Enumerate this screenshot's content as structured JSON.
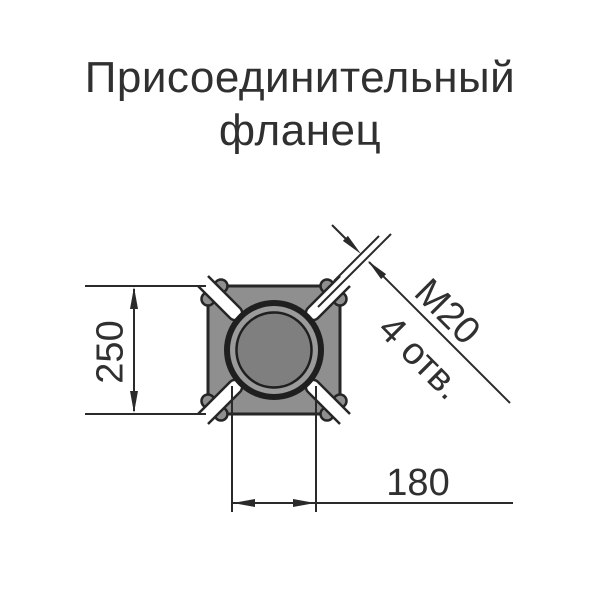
{
  "title": {
    "line1": "Присоединительный",
    "line2": "фланец"
  },
  "dimensions": {
    "height": "250",
    "bolt_spacing": "180",
    "thread": "М20",
    "holes": "4 отв."
  },
  "colors": {
    "background": "#ffffff",
    "line": "#2a2a2a",
    "text": "#303030",
    "flange_body": "#8f8f8f",
    "flange_ring_gap": "#9b9b9b",
    "flange_bore": "#7f7f7f",
    "slot_fill": "#ffffff"
  }
}
